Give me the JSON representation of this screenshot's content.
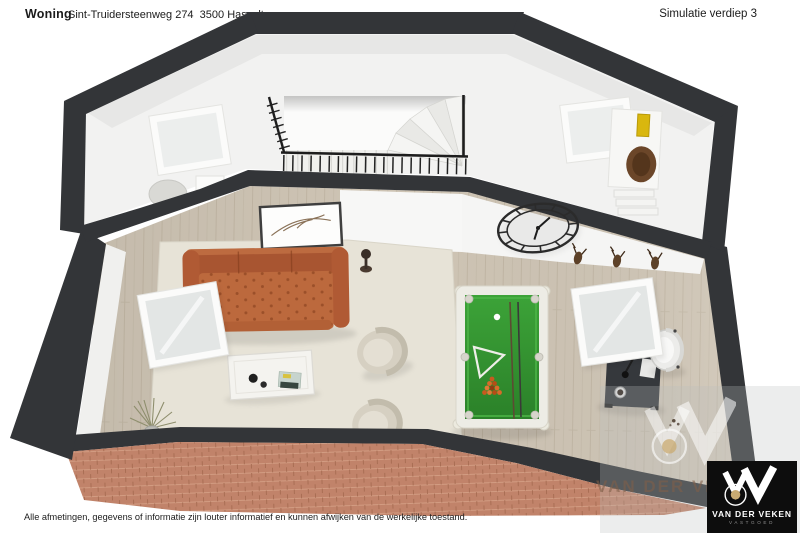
{
  "header": {
    "property_label": "Woning",
    "address": "Sint-Truidersteenweg 274  3500 Hasselt",
    "simulation": "Simulatie verdiep 3"
  },
  "footer": {
    "disclaimer": "Alle afmetingen, gegevens of informatie zijn louter informatief en kunnen afwijken van de werkelijke toestand."
  },
  "watermark": {
    "text": "VAN DER VEKEN",
    "logo": {
      "name": "VAN DER VEKEN",
      "tagline": "VASTGOED"
    }
  },
  "floorplan": {
    "view": "3D dollhouse top view, attic floor with stair landing",
    "furniture": [
      "staircase-with-railing",
      "tufted-sofa",
      "coffee-table",
      "armchair",
      "armchair",
      "pool-table",
      "office-desk",
      "office-chair",
      "wall-clock",
      "skylight-window",
      "skylight-window",
      "skylight-window",
      "skylight-window",
      "dresser",
      "shelf-unit",
      "stool",
      "storage-box",
      "picture-frame-branches",
      "dried-plant",
      "deer-trophies",
      "wall-sculpture"
    ]
  },
  "colors": {
    "wall": "#333538",
    "upper_floor": "#f2f2f1",
    "wood": "#cfc5b5",
    "rug": "#e7e3d7",
    "sofa": "#bc693d",
    "sofa_dark": "#8f4426",
    "pool_felt": "#2f8f2c",
    "pool_frame": "#edece5",
    "brick": "#c1836a",
    "armchair": "#d6d0c2",
    "desk": "#35383c",
    "accent_gold": "#c9ab72",
    "logo_bg": "#0d0d0d"
  }
}
